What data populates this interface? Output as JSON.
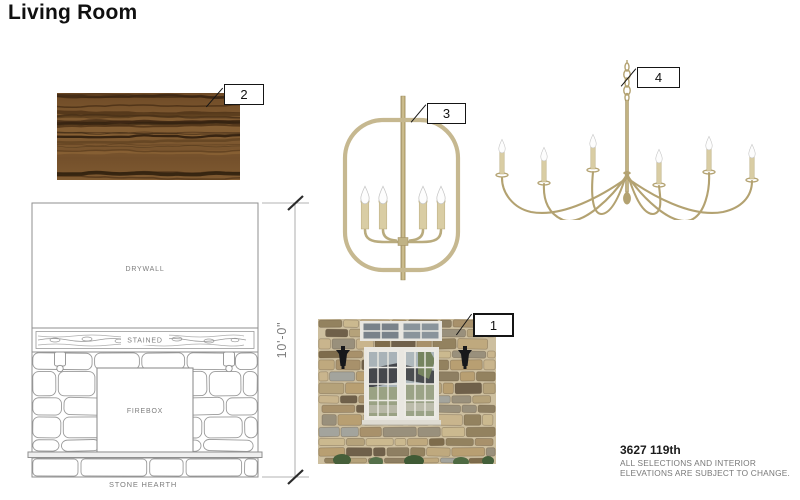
{
  "title": "Living Room",
  "callouts": {
    "c1": "1",
    "c2": "2",
    "c3": "3",
    "c4": "4"
  },
  "elevation": {
    "drywall": "DRYWALL",
    "stained": "STAINED",
    "firebox": "FIREBOX",
    "hearth": "STONE HEARTH",
    "dimension": "10'-0\""
  },
  "footer": {
    "project": "3627 119th",
    "note1": "ALL SELECTIONS AND INTERIOR",
    "note2": "ELEVATIONS ARE SUBJECT TO CHANGE."
  },
  "colors": {
    "brass": "#b3a271",
    "brass_light": "#c6b890",
    "candle_cream": "#d9cda4",
    "line_gray": "#8f8f8f",
    "text_gray": "#7d7d7d",
    "wood_base": "#7a5530",
    "wood_dark": "#3a2512",
    "stone_tan": "#c9b58d"
  }
}
